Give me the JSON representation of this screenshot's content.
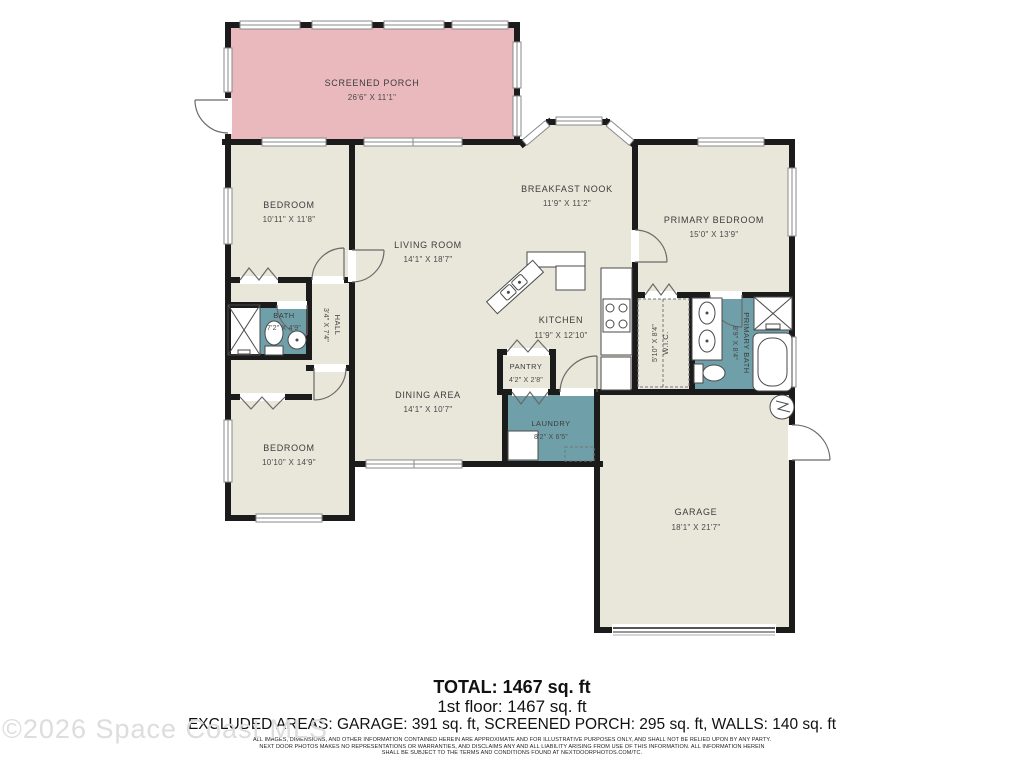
{
  "colors": {
    "porch": "#eab9bd",
    "room": "#e9e6da",
    "wet": "#6f9fa9",
    "wall": "#1b1b1b"
  },
  "rooms": {
    "screened_porch": {
      "name": "SCREENED PORCH",
      "dims": "26'6\" X 11'1\""
    },
    "bedroom_top": {
      "name": "BEDROOM",
      "dims": "10'11\" X 11'8\""
    },
    "living_room": {
      "name": "LIVING ROOM",
      "dims": "14'1\" X 18'7\""
    },
    "breakfast_nook": {
      "name": "BREAKFAST NOOK",
      "dims": "11'9\" X 11'2\""
    },
    "primary_bedroom": {
      "name": "PRIMARY BEDROOM",
      "dims": "15'0\" X 13'9\""
    },
    "bath": {
      "name": "BATH",
      "dims": "7'2\" X 4'9\""
    },
    "hall": {
      "name": "HALL",
      "dims": "3'4\" X 7'4\""
    },
    "kitchen": {
      "name": "KITCHEN",
      "dims": "11'9\" X 12'10\""
    },
    "wic": {
      "name": "W.I.C.",
      "dims": "5'10\" X 8'4\""
    },
    "primary_bath": {
      "name": "PRIMARY BATH",
      "dims": "8'9\" X 8'4\""
    },
    "pantry": {
      "name": "PANTRY",
      "dims": "4'2\" X 2'8\""
    },
    "dining_area": {
      "name": "DINING AREA",
      "dims": "14'1\" X 10'7\""
    },
    "laundry": {
      "name": "LAUNDRY",
      "dims": "8'2\" X 6'5\""
    },
    "bedroom_bottom": {
      "name": "BEDROOM",
      "dims": "10'10\" X 14'9\""
    },
    "garage": {
      "name": "GARAGE",
      "dims": "18'1\" X 21'7\""
    }
  },
  "summary": {
    "total": "TOTAL: 1467 sq. ft",
    "floor": "1st floor: 1467 sq. ft",
    "excluded": "EXCLUDED AREAS: GARAGE: 391 sq. ft, SCREENED PORCH: 295 sq. ft, WALLS: 140 sq. ft"
  },
  "disclaimer": {
    "line1": "ALL IMAGES, DIMENSIONS, AND OTHER INFORMATION CONTAINED HEREIN ARE APPROXIMATE AND FOR ILLUSTRATIVE PURPOSES ONLY, AND SHALL NOT BE RELIED UPON BY ANY PARTY.",
    "line2": "NEXT DOOR PHOTOS MAKES NO REPRESENTATIONS OR WARRANTIES, AND DISCLAIMS ANY AND ALL LIABILITY ARISING FROM USE OF THIS INFORMATION. ALL INFORMATION HEREIN",
    "line3": "SHALL BE SUBJECT TO THE TERMS AND CONDITIONS FOUND AT NEXTDOORPHOTOS.COM/TC."
  },
  "watermark": "©2026 Space Coast MLS"
}
